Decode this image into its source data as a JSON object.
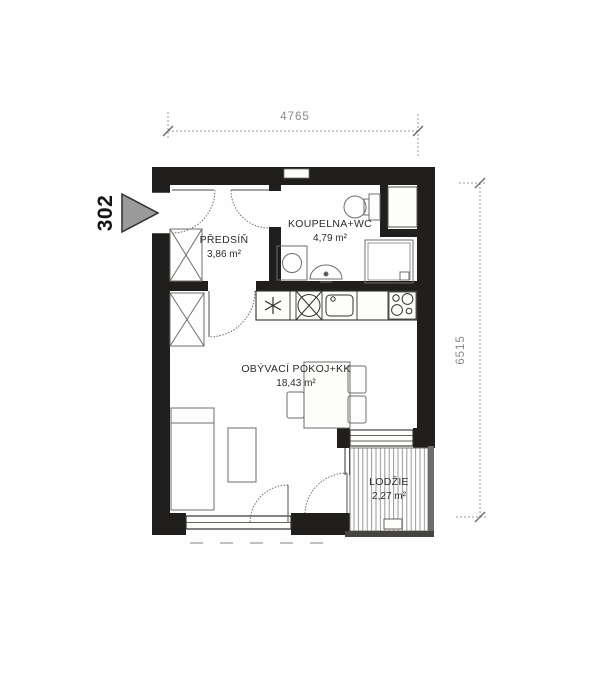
{
  "unit": {
    "number": "302"
  },
  "rooms": {
    "hallway": {
      "name": "PŘEDSÍŇ",
      "area": "3,86 m²"
    },
    "bathroom": {
      "name": "KOUPELNA+WC",
      "area": "4,79 m²"
    },
    "living": {
      "name": "OBÝVACÍ POKOJ+KK",
      "area": "18,43 m²"
    },
    "loggia": {
      "name": "LODŽIE",
      "area": "2,27 m²"
    }
  },
  "dimensions": {
    "top_width_mm": "4765",
    "right_height_mm": "6515"
  },
  "colors": {
    "wall": "#211f1d",
    "arrow_fill": "#9a9a9a",
    "dim_line": "#8a8a8a"
  }
}
